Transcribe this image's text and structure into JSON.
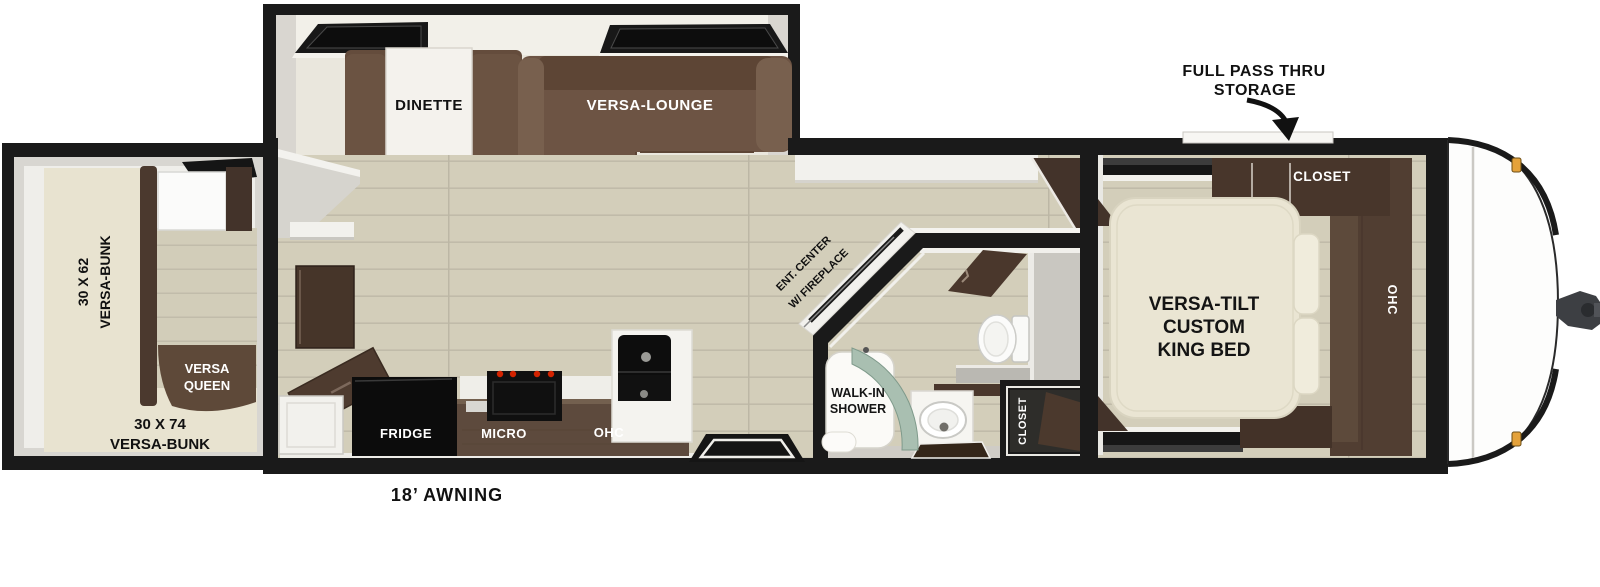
{
  "floorplan": {
    "annotations": {
      "panoramic_windows": "PANORAMIC WINDOWS",
      "pass_thru_line1": "FULL PASS THRU",
      "pass_thru_line2": "STORAGE",
      "awning": "18’ AWNING"
    },
    "slideout": {
      "dinette": "DINETTE",
      "lounge": "VERSA-LOUNGE"
    },
    "bunk_room": {
      "left_bunk_size": "30 X 62",
      "left_bunk_name": "VERSA-BUNK",
      "queen_line1": "VERSA",
      "queen_line2": "QUEEN",
      "rear_bunk_size": "30 X 74",
      "rear_bunk_name": "VERSA-BUNK"
    },
    "kitchen": {
      "fridge": "FRIDGE",
      "micro": "MICRO",
      "ohc": "OHC"
    },
    "living": {
      "ent_center_line1": "ENT. CENTER",
      "ent_center_line2": "W/ FIREPLACE"
    },
    "bathroom": {
      "shower_line1": "WALK-IN",
      "shower_line2": "SHOWER",
      "closet": "CLOSET"
    },
    "bedroom": {
      "closet": "CLOSET",
      "ohc": "OHC",
      "bed_line1": "VERSA-TILT",
      "bed_line2": "CUSTOM",
      "bed_line3": "KING BED"
    }
  },
  "colors": {
    "wall_black": "#1a1a1a",
    "floor_wood": "#d3ceba",
    "slide_floor": "#eae7dd",
    "wall_gray": "#d8d6d1",
    "sofa_brown": "#6d5444",
    "cabinet_dark": "#4a372c",
    "kitchen_cabinet": "#5d4a3d",
    "bunk_cream": "#e8e3d0",
    "shower_glass": "#a9bfb1",
    "appliance_black": "#0d0d0d",
    "stove_knob_red": "#d32300",
    "clearance_light": "#e4a23b"
  }
}
